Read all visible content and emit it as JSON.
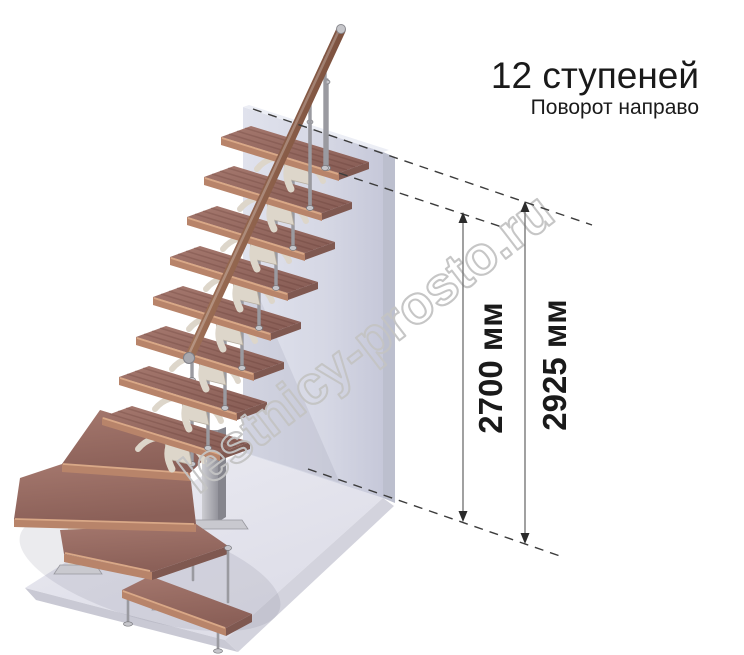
{
  "header": {
    "title": "12 ступеней",
    "subtitle": "Поворот направо"
  },
  "dimensions": {
    "height_to_top_step": {
      "label": "2700 мм",
      "value": "2700",
      "unit": "мм"
    },
    "total_height": {
      "label": "2925 мм",
      "value": "2925",
      "unit": "мм"
    }
  },
  "watermark": {
    "text": "lestnicy-prosto.ru"
  },
  "colors": {
    "ink": "#1a1a1a",
    "dash": "#3c3c3c",
    "dimline": "#6e6e6e",
    "arrow": "#2b2b2b",
    "watermark": "#c4c4c4",
    "wood-top": "#9a6d64",
    "wood-front": "#b8846a",
    "handrail": "#8f5f49",
    "metal": "#9a9aa0",
    "cream": "#ddd6ca",
    "wall": "#d8dae6",
    "wall-side": "#bcbfce",
    "floor": "#e6e6ee",
    "floor-edge": "#c9c9d4"
  }
}
